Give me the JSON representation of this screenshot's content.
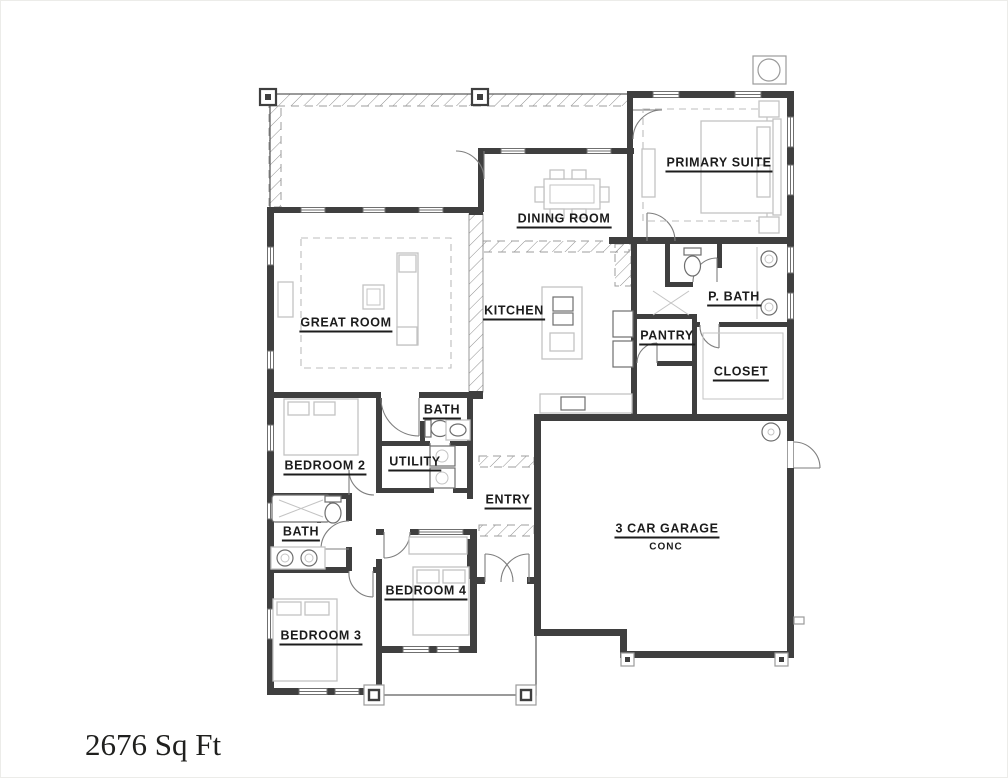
{
  "plan": {
    "type": "single-story residential floor plan",
    "area_text": "2676 Sq Ft",
    "rooms": {
      "primary_suite": "PRIMARY SUITE",
      "dining_room": "DINING ROOM",
      "great_room": "GREAT ROOM",
      "kitchen": "KITCHEN",
      "pantry": "PANTRY",
      "p_bath": "P. BATH",
      "closet": "CLOSET",
      "bath_hall": "BATH",
      "bedroom_2": "BEDROOM 2",
      "utility": "UTILITY",
      "entry": "ENTRY",
      "garage": "3 CAR GARAGE",
      "garage_floor": "CONC",
      "bath_left": "BATH",
      "bedroom_4": "BEDROOM 4",
      "bedroom_3": "BEDROOM 3"
    },
    "colors": {
      "wall": "#3f3f3f",
      "furniture_outline": "#c3c3c3",
      "fixture_outline": "#6e6e6e",
      "label_text": "#1c1c1c",
      "background": "#ffffff"
    }
  }
}
